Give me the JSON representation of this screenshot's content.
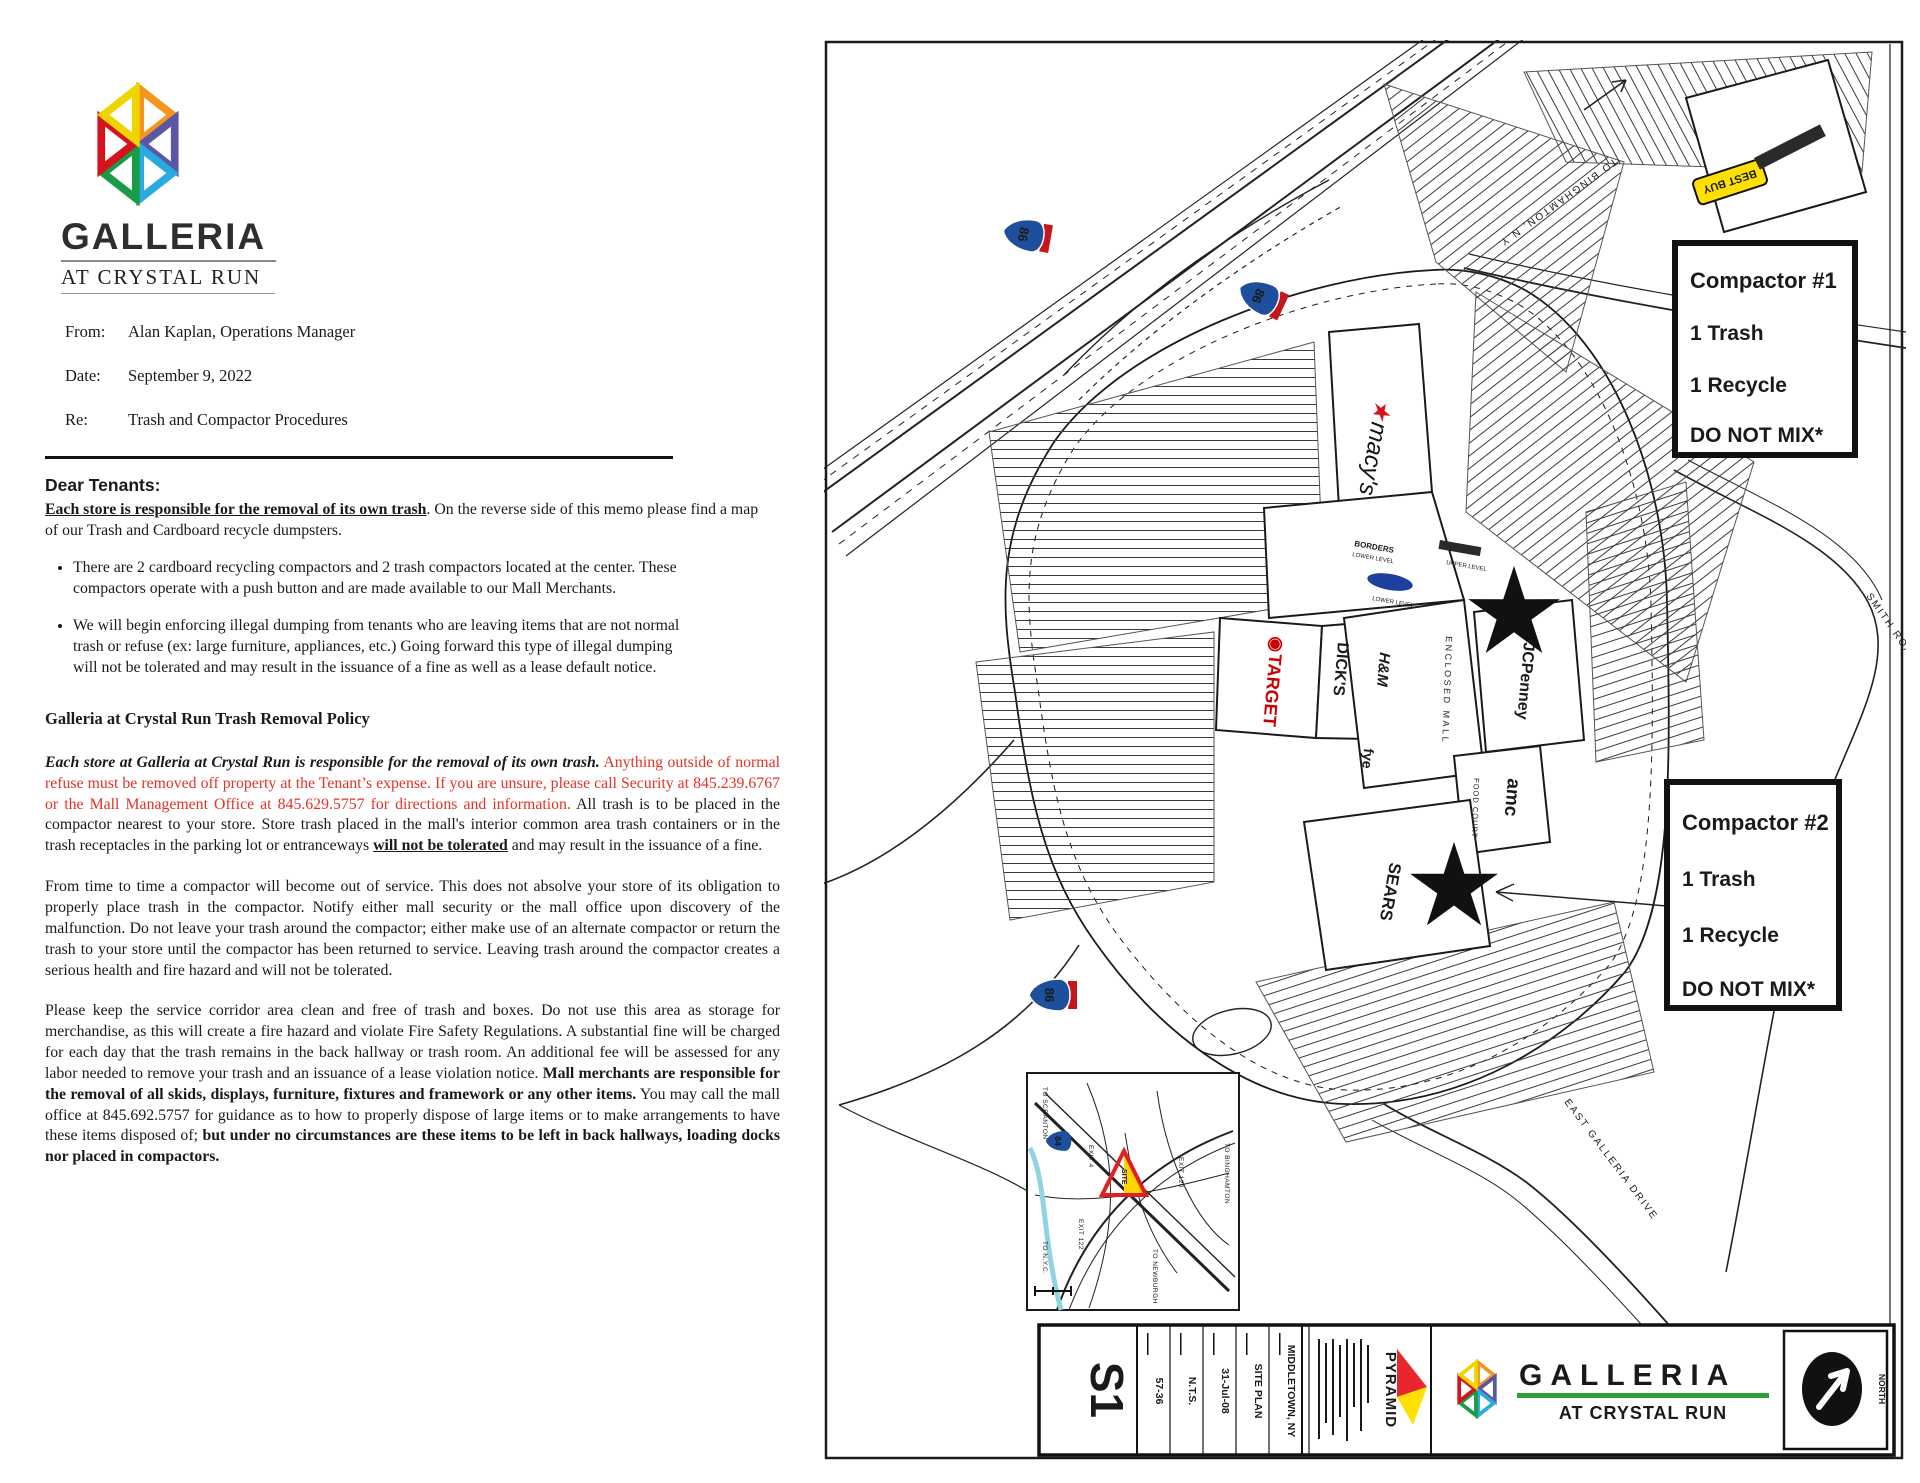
{
  "memo": {
    "logo": {
      "title": "GALLERIA",
      "subtitle": "AT CRYSTAL RUN"
    },
    "header_fields": [
      {
        "label": "From:",
        "value": "Alan Kaplan, Operations Manager"
      },
      {
        "label": "Date:",
        "value": "September 9, 2022"
      },
      {
        "label": "Re:",
        "value": "Trash and Compactor Procedures"
      }
    ],
    "salutation": "Dear Tenants:",
    "intro": {
      "bold_underline": "Each store is responsible for the removal of its own trash",
      "rest": ".  On the reverse side of this memo please find a map of our Trash and Cardboard  recycle dumpsters."
    },
    "bullets": [
      "There are 2 cardboard recycling compactors and 2 trash compactors located at the center.  These compactors operate with a push button and are made available to our Mall Merchants.",
      "We will begin enforcing illegal dumping from tenants who are leaving items that are not normal trash or refuse (ex: large furniture, appliances, etc.) Going forward this type of illegal dumping will not be tolerated and may result in the issuance of a fine as well as a lease default notice."
    ],
    "policy_heading": "Galleria at Crystal Run Trash Removal Policy",
    "policy_para": {
      "bold_italic": "Each store at Galleria at Crystal Run is responsible for the removal of its own trash.",
      "red": " Anything outside of normal refuse must be removed off property at the Tenant’s expense. If you are unsure, please call Security at 845.239.6767 or the Mall Management Office at 845.629.5757 for directions and information.",
      "black1": " All trash is to be placed in the compactor nearest to your store. Store trash placed in the mall's interior common area trash containers or in the trash receptacles in  the parking lot or entranceways ",
      "bold_underline": "will not be tolerated",
      "black2": " and may result in the issuance of a fine."
    },
    "para_service": "From time to time a  compactor will become out of service. This does not absolve your store of  its obligation to properly place trash in the compactor. Notify either mall security or the mall office upon discovery of the malfunction. Do not leave your trash around the compactor; either make use of an alternate compactor or return the trash to your store until the compactor has been returned to service. Leaving trash around the compactor creates a serious health and fire hazard and will not be tolerated.",
    "para_corridor": {
      "text1": "Please keep the service corridor area clean and  free of trash and boxes. Do not use this area as storage for merchandise, as this will create a fire hazard and violate  Fire Safety Regulations. A substantial fine will be charged for each day that the trash remains in the back hallway  or trash room. An additional fee will be assessed for any labor needed to remove your trash and an issuance of a  lease violation notice. ",
      "bold1": "Mall merchants are responsible for the removal of all skids, displays, furniture, fixtures and framework or any other items.",
      "text2": " You may call the mall office at 845.692.5757 for guidance as to how to properly dispose of large items or to make arrangements to have these items disposed of; ",
      "bold2": "but under no circumstances are these items to be left in back hallways, loading docks nor placed in compactors."
    }
  },
  "map": {
    "compactor1": {
      "title": "Compactor #1",
      "trash": "1 Trash",
      "recycle": "1 Recycle",
      "warning": "DO NOT MIX*"
    },
    "compactor2": {
      "title": "Compactor #2",
      "trash": "1 Trash",
      "recycle": "1 Recycle",
      "warning": "DO NOT MIX*"
    },
    "stores": {
      "macys_star": "★",
      "macys": "macy's",
      "target_bullseye": "◉",
      "target": "TARGET",
      "dicks": "DICK'S",
      "hm": "H&M",
      "jcpenney": "JCPenney",
      "amc": "amc",
      "sears": "SEARS",
      "fye": "fye",
      "bestbuy": "BEST BUY",
      "borders": "BORDERS",
      "lower_level": "LOWER LEVEL",
      "upper_level": "UPPER LEVEL"
    },
    "areas": {
      "enclosed_mall": "ENCLOSED MALL",
      "food_court": "FOOD COURT"
    },
    "roads": {
      "binghamton": "TO BINGHAMTON, N.Y.",
      "north_galleria": "NORTH   GALLERIA",
      "smith": "SMITH ROAD",
      "east_galleria": "EAST GALLERIA DRIVE"
    },
    "shields": {
      "interstate86": "86",
      "interstate84": "84"
    },
    "inset": {
      "scranton": "TO SCRANTON",
      "nyc": "TO N.Y.C.",
      "newburgh": "TO NEWBURGH",
      "binghamton": "TO BINGHAMTON",
      "exit4": "EXIT 4",
      "exit122": "EXIT 122",
      "exit120": "EXIT 120",
      "site": "SITE"
    },
    "titleblock": {
      "sheet": "S1",
      "fields": [
        "57-36",
        "N.T.S.",
        "31-Jul-08",
        "SITE PLAN",
        "MIDDLETOWN, NY"
      ],
      "pyramid": "PYRAMID",
      "galleria": "GALLERIA",
      "tagline": "AT CRYSTAL RUN",
      "north": "NORTH"
    }
  }
}
